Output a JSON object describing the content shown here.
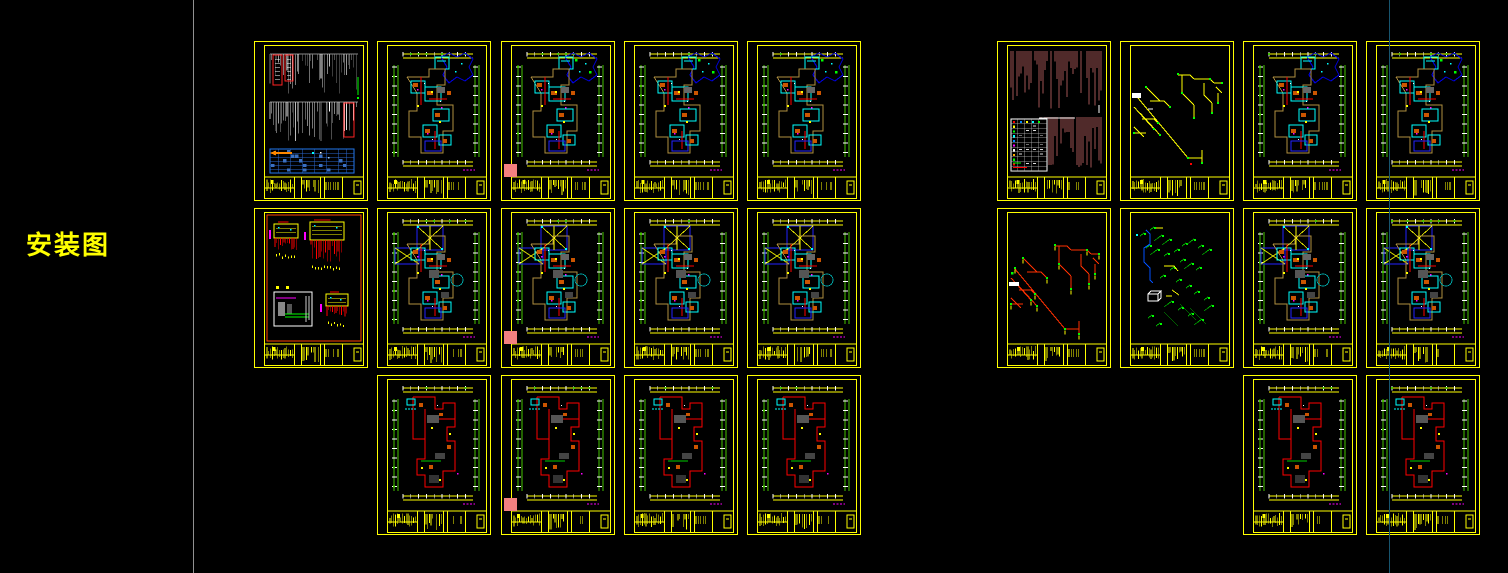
{
  "app": {
    "background": "#000000"
  },
  "annotation": {
    "label": "安装图",
    "color": "#ffff00",
    "x": 26,
    "y": 233,
    "font_size": 26
  },
  "guides": {
    "gray_divider": {
      "x": 193,
      "color": "#919191"
    },
    "teal_guide": {
      "x": 1389,
      "color": "#17546e"
    }
  },
  "palette": {
    "frame": "#ffff00",
    "red": "#ff0000",
    "orange_red": "#ff4400",
    "cyan": "#00ffff",
    "blue": "#2222ff",
    "deep_blue": "#0000dd",
    "green_dim": "#44c400",
    "bright_green": "#00ff00",
    "orange": "#cc5500",
    "magenta": "#ff00ff",
    "maroon": "#a05555",
    "tan": "#b09040",
    "white": "#ffffff",
    "table_blue": "#3a6fc0",
    "pink_marker": "#f28080",
    "gray_text": "#bbbbbb"
  },
  "layout": {
    "sheet_w": 114,
    "sheet_h": 160,
    "left_cols_x": [
      254,
      377,
      501,
      624,
      747
    ],
    "right_cols_x": [
      997,
      1120,
      1243,
      1366
    ],
    "rows_y": [
      41,
      208,
      375
    ]
  },
  "sheets": [
    {
      "id": "L-1-1",
      "group": "left",
      "col": 0,
      "row": 0,
      "type": "design-notes"
    },
    {
      "id": "L-1-2",
      "group": "left",
      "col": 1,
      "row": 0,
      "type": "floor-plan"
    },
    {
      "id": "L-1-3",
      "group": "left",
      "col": 2,
      "row": 0,
      "type": "floor-plan",
      "marker": "pink-square"
    },
    {
      "id": "L-1-4",
      "group": "left",
      "col": 3,
      "row": 0,
      "type": "floor-plan"
    },
    {
      "id": "L-1-5",
      "group": "left",
      "col": 4,
      "row": 0,
      "type": "floor-plan"
    },
    {
      "id": "L-2-1",
      "group": "left",
      "col": 0,
      "row": 1,
      "type": "electrical-detail"
    },
    {
      "id": "L-2-2",
      "group": "left",
      "col": 1,
      "row": 1,
      "type": "roof-plan"
    },
    {
      "id": "L-2-3",
      "group": "left",
      "col": 2,
      "row": 1,
      "type": "roof-plan",
      "marker": "pink-square"
    },
    {
      "id": "L-2-4",
      "group": "left",
      "col": 3,
      "row": 1,
      "type": "roof-plan"
    },
    {
      "id": "L-2-5",
      "group": "left",
      "col": 4,
      "row": 1,
      "type": "roof-plan"
    },
    {
      "id": "L-3-2",
      "group": "left",
      "col": 1,
      "row": 2,
      "type": "wiring-plan"
    },
    {
      "id": "L-3-3",
      "group": "left",
      "col": 2,
      "row": 2,
      "type": "wiring-plan",
      "marker": "pink-square"
    },
    {
      "id": "L-3-4",
      "group": "left",
      "col": 3,
      "row": 2,
      "type": "wiring-plan"
    },
    {
      "id": "L-3-5",
      "group": "left",
      "col": 4,
      "row": 2,
      "type": "wiring-plan"
    },
    {
      "id": "R-1-1",
      "group": "right",
      "col": 0,
      "row": 0,
      "type": "spec-notes"
    },
    {
      "id": "R-1-2",
      "group": "right",
      "col": 1,
      "row": 0,
      "type": "riser-yellow"
    },
    {
      "id": "R-1-3",
      "group": "right",
      "col": 2,
      "row": 0,
      "type": "floor-plan"
    },
    {
      "id": "R-1-4",
      "group": "right",
      "col": 3,
      "row": 0,
      "type": "floor-plan"
    },
    {
      "id": "R-2-1",
      "group": "right",
      "col": 0,
      "row": 1,
      "type": "riser-red"
    },
    {
      "id": "R-2-2",
      "group": "right",
      "col": 1,
      "row": 1,
      "type": "riser-green"
    },
    {
      "id": "R-2-3",
      "group": "right",
      "col": 2,
      "row": 1,
      "type": "roof-plan"
    },
    {
      "id": "R-2-4",
      "group": "right",
      "col": 3,
      "row": 1,
      "type": "roof-plan"
    },
    {
      "id": "R-3-3",
      "group": "right",
      "col": 2,
      "row": 2,
      "type": "wiring-plan"
    },
    {
      "id": "R-3-4",
      "group": "right",
      "col": 3,
      "row": 2,
      "type": "wiring-plan"
    }
  ]
}
